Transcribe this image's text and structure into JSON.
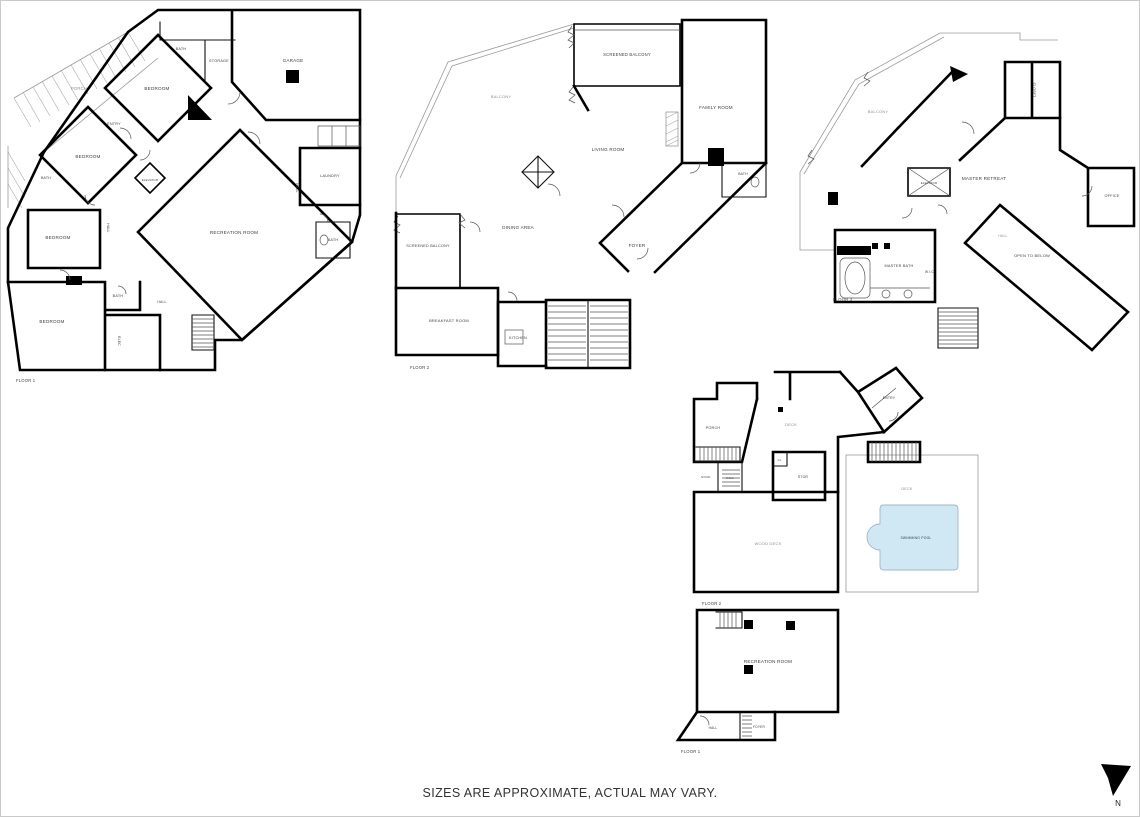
{
  "page": {
    "disclaimer": "SIZES ARE APPROXIMATE, ACTUAL MAY VARY.",
    "north_label": "N",
    "background": "#ffffff",
    "wall_color": "#000000",
    "outdoor_label_color": "#8f8f8f",
    "room_label_color": "#3d3d3d",
    "pool_fill": "#cfe8f4"
  },
  "plans": [
    {
      "name": "main-house-bedroom-level",
      "labels": [
        {
          "t": "PORCH",
          "x": 79,
          "y": 90,
          "o": true,
          "s": 4.2
        },
        {
          "t": "BEDROOM",
          "x": 157,
          "y": 90
        },
        {
          "t": "BATH",
          "x": 181,
          "y": 50,
          "s": 3.8
        },
        {
          "t": "STORAGE",
          "x": 219,
          "y": 62,
          "s": 3.8
        },
        {
          "t": "GARAGE",
          "x": 293,
          "y": 62
        },
        {
          "t": "ENTRY",
          "x": 114,
          "y": 125,
          "s": 3.8
        },
        {
          "t": "BEDROOM",
          "x": 88,
          "y": 158
        },
        {
          "t": "ELEVATOR",
          "x": 150,
          "y": 181,
          "s": 2.9
        },
        {
          "t": "HALL",
          "x": 107,
          "y": 228,
          "s": 3.4,
          "r": 90
        },
        {
          "t": "BEDROOM",
          "x": 58,
          "y": 239
        },
        {
          "t": "LAUNDRY",
          "x": 330,
          "y": 177,
          "s": 3.8
        },
        {
          "t": "HALL",
          "x": 296,
          "y": 188,
          "s": 3.4,
          "r": 90
        },
        {
          "t": "BATH",
          "x": 333,
          "y": 241,
          "s": 3.8
        },
        {
          "t": "RECREATION ROOM",
          "x": 234,
          "y": 234
        },
        {
          "t": "BATH",
          "x": 46,
          "y": 179,
          "s": 3.6
        },
        {
          "t": "BATH",
          "x": 118,
          "y": 297,
          "s": 3.8
        },
        {
          "t": "HALL",
          "x": 162,
          "y": 303,
          "s": 3.4
        },
        {
          "t": "BEDROOM",
          "x": 52,
          "y": 323
        },
        {
          "t": "ELEC",
          "x": 118,
          "y": 341,
          "s": 3.4,
          "r": 90
        },
        {
          "t": "FLOOR 1",
          "x": 16,
          "y": 382,
          "s": 4.2,
          "a": "start",
          "c": "#444"
        }
      ]
    },
    {
      "name": "main-house-living-level",
      "labels": [
        {
          "t": "SCREENED BALCONY",
          "x": 627,
          "y": 56,
          "s": 4.2
        },
        {
          "t": "BALCONY",
          "x": 501,
          "y": 98,
          "o": true,
          "s": 4
        },
        {
          "t": "FAMILY ROOM",
          "x": 716,
          "y": 109
        },
        {
          "t": "LIVING ROOM",
          "x": 608,
          "y": 151
        },
        {
          "t": "DINING AREA",
          "x": 518,
          "y": 229
        },
        {
          "t": "SCREENED BALCONY",
          "x": 428,
          "y": 247,
          "s": 3.8
        },
        {
          "t": "FOYER",
          "x": 637,
          "y": 247
        },
        {
          "t": "BATH",
          "x": 743,
          "y": 175,
          "s": 3.4
        },
        {
          "t": "BREAKFAST ROOM",
          "x": 449,
          "y": 322,
          "s": 4
        },
        {
          "t": "KITCHEN",
          "x": 518,
          "y": 339,
          "s": 3.8
        },
        {
          "t": "FLOOR 2",
          "x": 410,
          "y": 369,
          "s": 4.2,
          "a": "start",
          "c": "#444"
        }
      ]
    },
    {
      "name": "main-house-master-level",
      "labels": [
        {
          "t": "BALCONY",
          "x": 878,
          "y": 113,
          "o": true,
          "s": 4
        },
        {
          "t": "CLOSET",
          "x": 1033,
          "y": 90,
          "s": 3.4,
          "r": 90
        },
        {
          "t": "ELEVATOR",
          "x": 929,
          "y": 184,
          "s": 2.9
        },
        {
          "t": "MASTER RETREAT",
          "x": 984,
          "y": 180
        },
        {
          "t": "OFFICE",
          "x": 1112,
          "y": 197,
          "s": 3.8
        },
        {
          "t": "HALL",
          "x": 1003,
          "y": 237,
          "o": true,
          "s": 3.4
        },
        {
          "t": "OPEN TO BELOW",
          "x": 1032,
          "y": 257,
          "s": 4
        },
        {
          "t": "MASTER BATH",
          "x": 899,
          "y": 267,
          "s": 3.8
        },
        {
          "t": "W.I.C.",
          "x": 930,
          "y": 273,
          "s": 3.2
        },
        {
          "t": "FLOOR 3",
          "x": 833,
          "y": 301,
          "s": 4.2,
          "a": "start",
          "c": "#444"
        }
      ]
    },
    {
      "name": "guest-house-upper-level",
      "labels": [
        {
          "t": "PORCH",
          "x": 713,
          "y": 429,
          "s": 3.8
        },
        {
          "t": "DECK",
          "x": 791,
          "y": 426,
          "o": true,
          "s": 4
        },
        {
          "t": "ENTRY",
          "x": 889,
          "y": 399,
          "s": 3.4
        },
        {
          "t": "STOR.",
          "x": 706,
          "y": 478,
          "s": 3
        },
        {
          "t": "HALL",
          "x": 730,
          "y": 479,
          "s": 3
        },
        {
          "t": "CL.",
          "x": 780,
          "y": 461,
          "s": 2.7
        },
        {
          "t": "STOR",
          "x": 803,
          "y": 478,
          "s": 3.4
        },
        {
          "t": "WOOD DECK",
          "x": 768,
          "y": 545,
          "o": true,
          "s": 4
        },
        {
          "t": "DECK",
          "x": 907,
          "y": 490,
          "o": true,
          "s": 3.8
        },
        {
          "t": "SWIMMING POOL",
          "x": 916,
          "y": 539,
          "s": 3.4,
          "c": "#6d7f8a"
        },
        {
          "t": "FLOOR 2",
          "x": 702,
          "y": 605,
          "s": 4.2,
          "a": "start",
          "c": "#444"
        }
      ]
    },
    {
      "name": "guest-house-ground-level",
      "labels": [
        {
          "t": "RECREATION ROOM",
          "x": 768,
          "y": 663
        },
        {
          "t": "HALL",
          "x": 713,
          "y": 729,
          "s": 3.2
        },
        {
          "t": "FOYER",
          "x": 759,
          "y": 728,
          "s": 3.2
        },
        {
          "t": "FLOOR 1",
          "x": 681,
          "y": 753,
          "s": 4.2,
          "a": "start",
          "c": "#444"
        }
      ]
    }
  ]
}
